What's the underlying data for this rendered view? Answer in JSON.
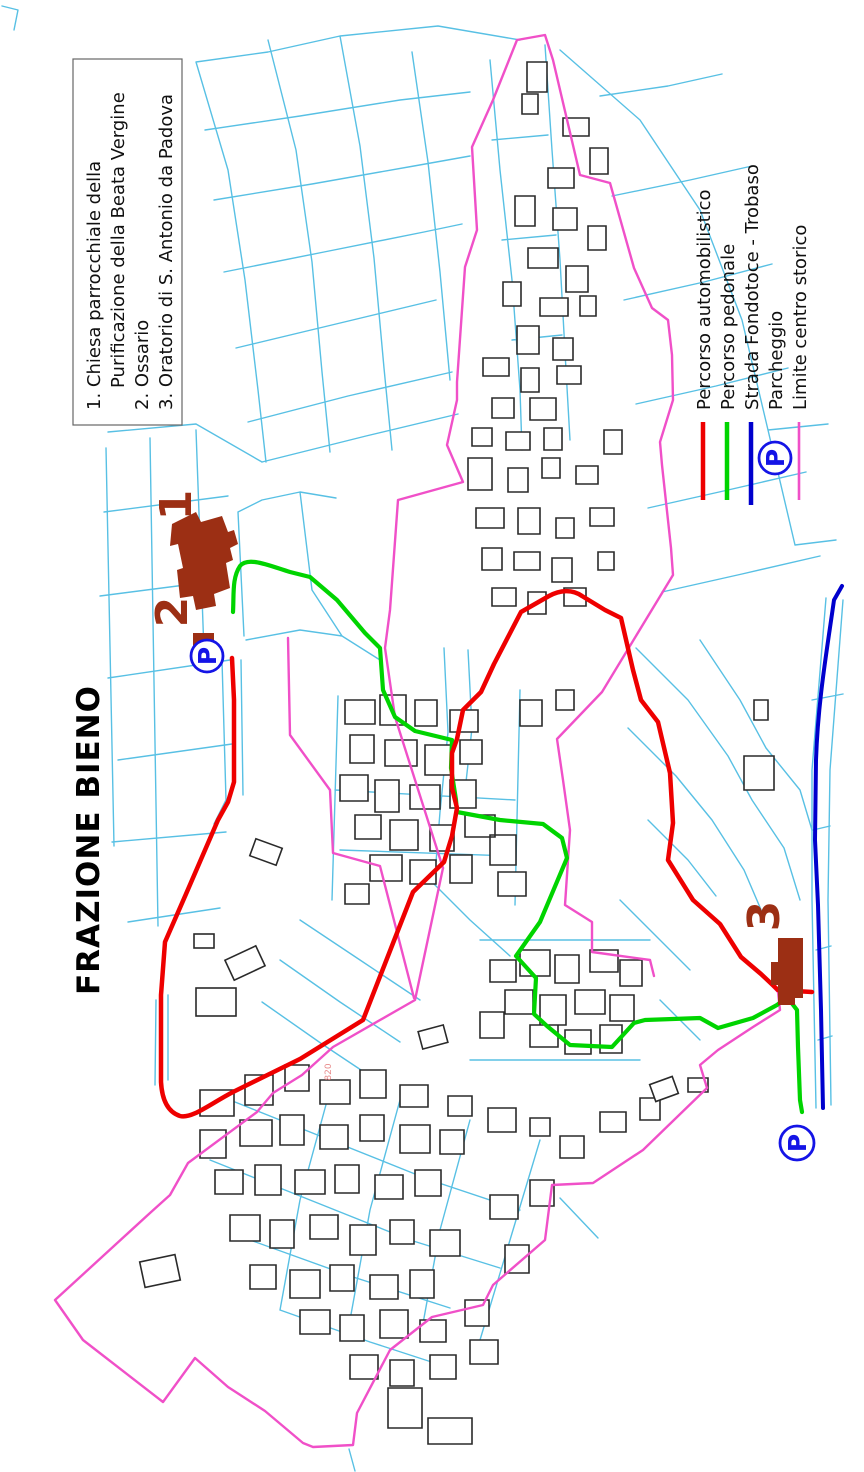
{
  "title": "FRAZIONE BIENO",
  "poi_legend": {
    "line1": "1. Chiesa parrocchiale della",
    "line2": "Purificazione della Beata Vergine",
    "line3": "2. Ossario",
    "line4": "3. Oratorio di S. Antonio da Padova"
  },
  "map_legend": {
    "items": [
      {
        "label": "Percorso automobilistico",
        "color": "#ee0000",
        "symbol": "line"
      },
      {
        "label": "Percorso pedonale",
        "color": "#00d400",
        "symbol": "line"
      },
      {
        "label": "Strada Fondotoce - Trobaso",
        "color": "#0000cd",
        "symbol": "line"
      },
      {
        "label": "Parcheggio",
        "color": "#1414e6",
        "symbol": "circle-P"
      },
      {
        "label": "Limite centro storico",
        "color": "#f050c8",
        "symbol": "line"
      }
    ]
  },
  "markers": {
    "num1": "1",
    "num2": "2",
    "num3": "3",
    "parking_letter": "P",
    "parcel_code": "820"
  },
  "colors": {
    "parcel_lines": "#58c0e4",
    "buildings_outline": "#2a2a2a",
    "monument_fill": "#9c2f14",
    "driving_route": "#ee0000",
    "pedestrian_route": "#00d400",
    "main_road": "#0000cd",
    "historic_boundary": "#f050c8",
    "parking_blue": "#1414e6"
  }
}
